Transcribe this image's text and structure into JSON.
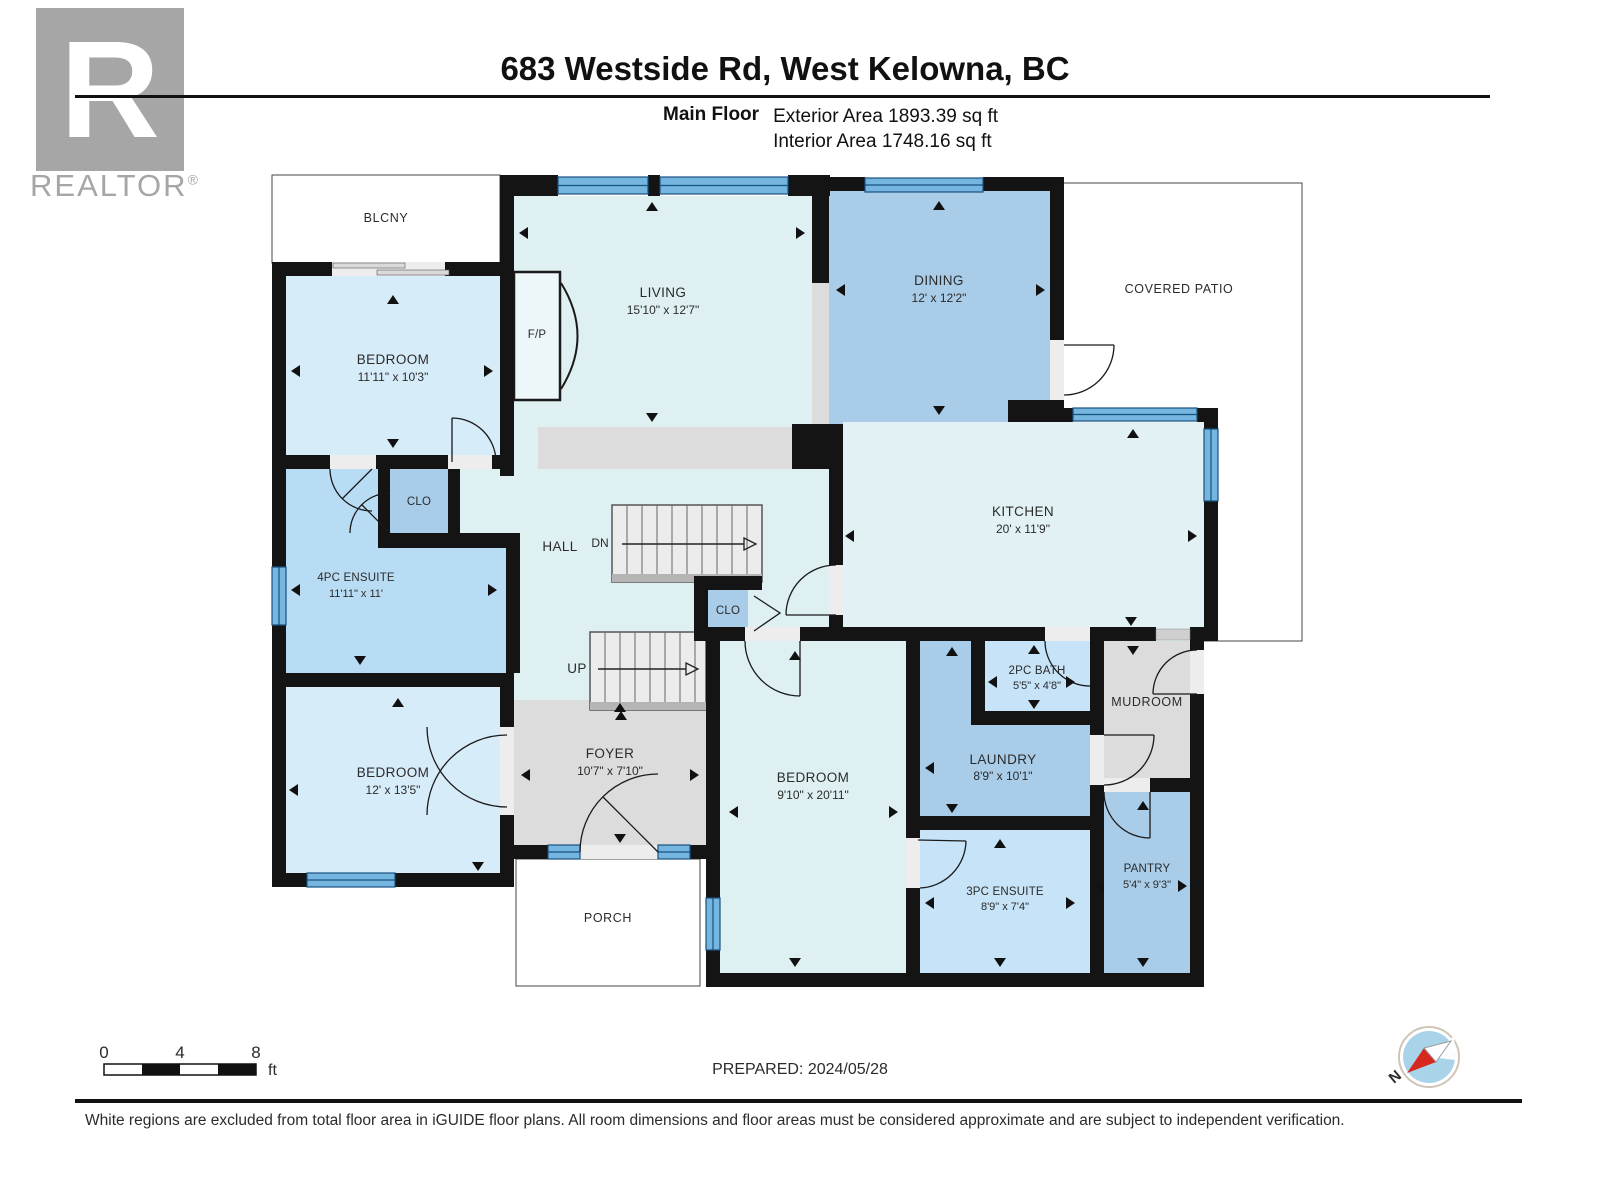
{
  "header": {
    "logo": {
      "r": "R",
      "word": "REALTOR",
      "reg": "®"
    },
    "title": "683 Westside Rd, West Kelowna, BC",
    "floor_label": "Main Floor",
    "exterior_area": "Exterior Area 1893.39 sq ft",
    "interior_area": "Interior Area 1748.16 sq ft"
  },
  "rooms": {
    "blcny": {
      "label": "BLCNY"
    },
    "bedroom1": {
      "label": "BEDROOM",
      "dims": "11'11\" x 10'3\""
    },
    "living": {
      "label": "LIVING",
      "dims": "15'10\" x 12'7\""
    },
    "fp": {
      "label": "F/P"
    },
    "dining": {
      "label": "DINING",
      "dims": "12' x 12'2\""
    },
    "covered_patio": {
      "label": "COVERED PATIO"
    },
    "kitchen": {
      "label": "KITCHEN",
      "dims": "20' x 11'9\""
    },
    "clo1": {
      "label": "CLO"
    },
    "clo2": {
      "label": "CLO"
    },
    "hall": {
      "label": "HALL"
    },
    "dn": {
      "label": "DN"
    },
    "up": {
      "label": "UP"
    },
    "ensuite4": {
      "label": "4PC ENSUITE",
      "dims": "11'11\" x 11'"
    },
    "bedroom12": {
      "label": "BEDROOM",
      "dims": "12' x 13'5\""
    },
    "foyer": {
      "label": "FOYER",
      "dims": "10'7\" x 7'10\""
    },
    "bedroom2": {
      "label": "BEDROOM",
      "dims": "9'10\" x 20'11\""
    },
    "laundry": {
      "label": "LAUNDRY",
      "dims": "8'9\" x 10'1\""
    },
    "bath2": {
      "label": "2PC BATH",
      "dims": "5'5\" x 4'8\""
    },
    "mudroom": {
      "label": "MUDROOM"
    },
    "porch": {
      "label": "PORCH"
    },
    "ensuite3": {
      "label": "3PC ENSUITE",
      "dims": "8'9\" x 7'4\""
    },
    "pantry": {
      "label": "PANTRY",
      "dims": "5'4\" x 9'3\""
    }
  },
  "footer": {
    "scale": {
      "n0": "0",
      "n4": "4",
      "n8": "8",
      "unit": "ft"
    },
    "prepared": "PREPARED: 2024/05/28",
    "north": "N",
    "disclaimer": "White regions are excluded from total floor area in iGUIDE floor plans. All room dimensions and floor areas must be considered approximate and are subject to independent verification."
  },
  "colors": {
    "wall": "#141414",
    "room_pale_cyan": "#dff0f3",
    "room_light_blue": "#d7ecf9",
    "room_mid_blue": "#a9cde9",
    "room_ensuite_blue": "#b9dcf5",
    "room_bath_blue": "#c6e3f8",
    "room_gray": "#dcdcdc",
    "window_blue": "#74b6e0",
    "window_edge": "#19517f",
    "compass_red": "#d6281e",
    "compass_disc": "#a9d3e8"
  }
}
